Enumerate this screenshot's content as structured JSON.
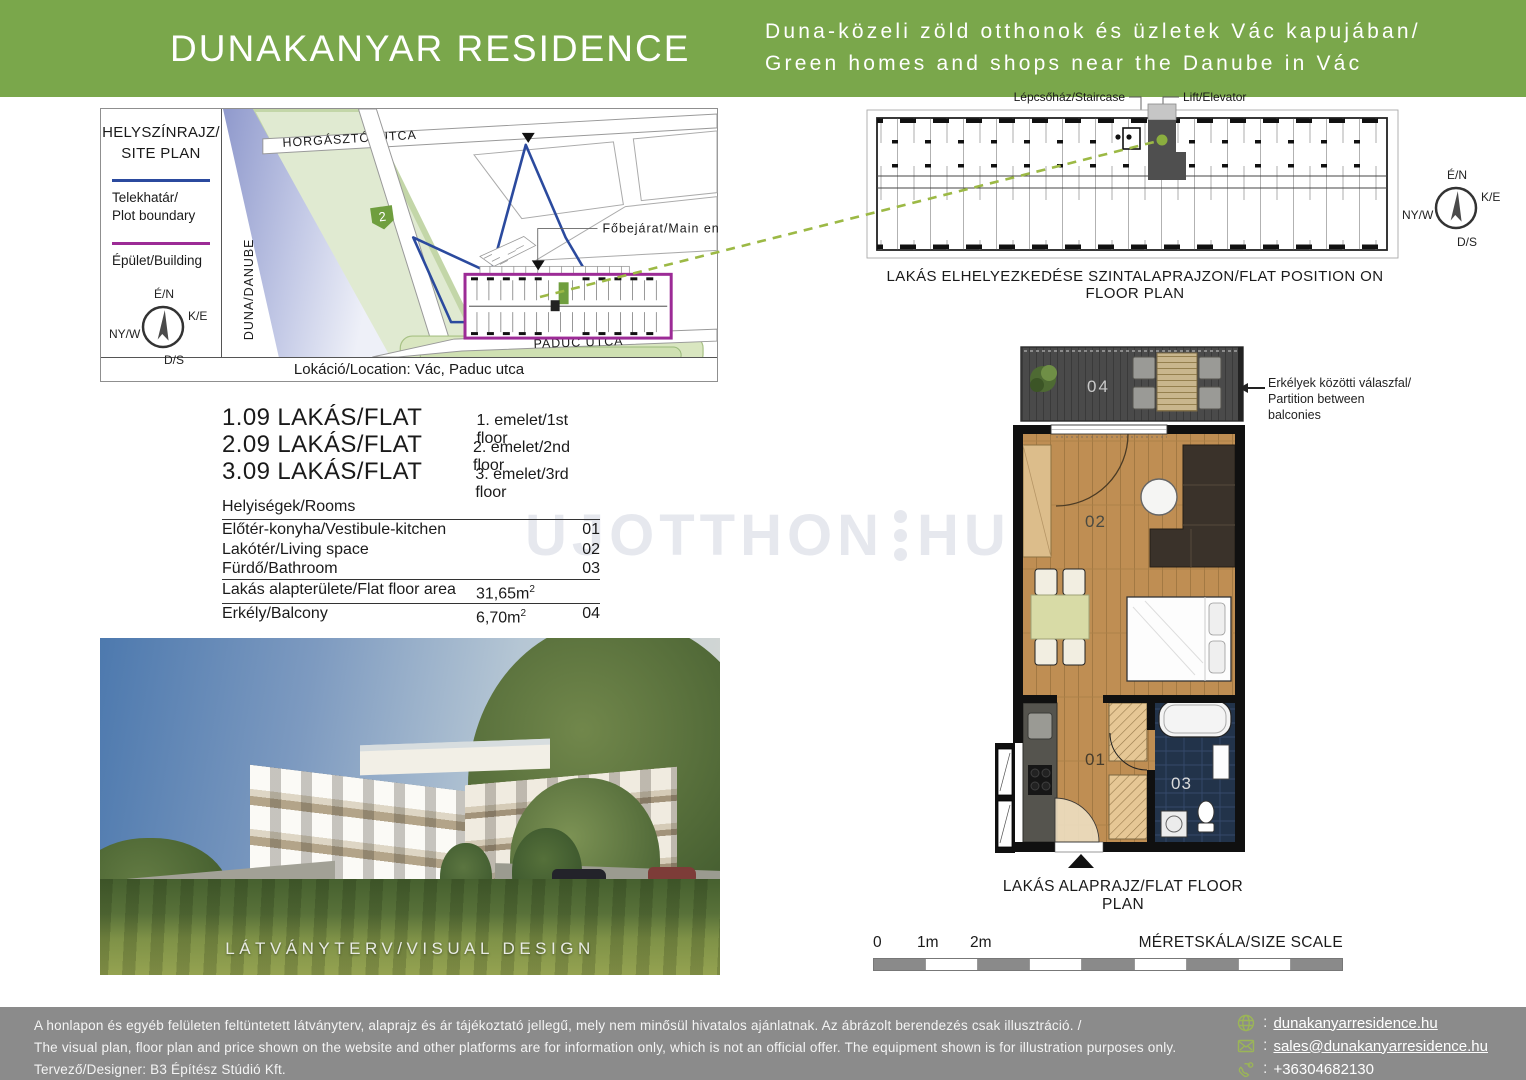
{
  "header": {
    "brand": "DUNAKANYAR RESIDENCE",
    "tagline_hu": "Duna-közeli zöld otthonok és üzletek Vác kapujában/",
    "tagline_en": "Green homes and shops near the Danube in Vác"
  },
  "site_plan": {
    "title_line1": "HELYSZÍNRAJZ/",
    "title_line2": "SITE PLAN",
    "legend_plot_line1": "Telekhatár/",
    "legend_plot_line2": "Plot boundary",
    "legend_building": "Épület/Building",
    "compass": {
      "n": "É/N",
      "e": "K/E",
      "w": "NY/W",
      "s": "D/S"
    },
    "river_label": "DUNA/DANUBE",
    "street_top": "HORGÁSZTÓI UTCA",
    "street_bottom": "PADUC UTCA",
    "road_badge": "2",
    "entrance_label": "Főbejárat/Main entrance",
    "caption": "Lokáció/Location: Vác, Paduc utca"
  },
  "floor_strip": {
    "label_staircase": "Lépcsőház/Staircase",
    "label_elevator": "Lift/Elevator",
    "caption": "LAKÁS ELHELYEZKEDÉSE SZINTALAPRAJZON/FLAT POSITION ON FLOOR PLAN",
    "compass": {
      "n": "É/N",
      "e": "K/E",
      "w": "NY/W",
      "s": "D/S"
    }
  },
  "flats": [
    {
      "id": "1.09 LAKÁS/FLAT",
      "floor": "1. emelet/1st floor"
    },
    {
      "id": "2.09 LAKÁS/FLAT",
      "floor": "2. emelet/2nd floor"
    },
    {
      "id": "3.09 LAKÁS/FLAT",
      "floor": "3. emelet/3rd floor"
    }
  ],
  "rooms": {
    "header": "Helyiségek/Rooms",
    "items": [
      {
        "label": "Előtér-konyha/Vestibule-kitchen",
        "num": "01"
      },
      {
        "label": "Lakótér/Living space",
        "num": "02"
      },
      {
        "label": "Fürdő/Bathroom",
        "num": "03"
      }
    ],
    "area_row": {
      "label": "Lakás alapterülete/Flat floor area",
      "value": "31,65m",
      "sup": "2"
    },
    "balcony_row": {
      "label": "Erkély/Balcony",
      "value": "6,70m",
      "sup": "2",
      "num": "04"
    }
  },
  "watermark": {
    "part1": "UJOTTHON",
    "part2": "HU"
  },
  "render": {
    "caption": "LÁTVÁNYTERV/VISUAL DESIGN"
  },
  "flat_plan": {
    "caption": "LAKÁS ALAPRAJZ/FLAT FLOOR PLAN",
    "annotation_line1": "Erkélyek közötti válaszfal/",
    "annotation_line2": "Partition between balconies",
    "room_labels": {
      "balcony": "04",
      "living": "02",
      "vestibule": "01",
      "bath": "03"
    }
  },
  "scale": {
    "ticks": [
      "0",
      "1m",
      "2m"
    ],
    "label": "MÉRETSKÁLA/SIZE SCALE",
    "segments": 9
  },
  "footer": {
    "disclaimer_hu": "A honlapon és egyéb felületen feltüntetett látványterv, alaprajz és ár tájékoztató jellegű, mely nem minősül hivatalos ajánlatnak. Az ábrázolt berendezés csak illusztráció. /",
    "disclaimer_en": "The visual plan, floor plan and price shown on the website and other platforms are for information only, which is not an official offer. The equipment shown is for illustration purposes only.",
    "designer": "Tervező/Designer:  B3 Építész Stúdió Kft.",
    "contacts": [
      {
        "icon": "globe-icon",
        "separator": ":",
        "label": "dunakanyarresidence.hu"
      },
      {
        "icon": "mail-icon",
        "separator": ":",
        "label": "sales@dunakanyarresidence.hu"
      },
      {
        "icon": "phone-icon",
        "separator": ":",
        "label": "+36304682130"
      }
    ]
  },
  "colors": {
    "brand_green": "#7aa74b",
    "accent_green": "#8cb14e",
    "plot_boundary_blue": "#2b4a9e",
    "building_purple": "#9c2b96",
    "footer_gray": "#8b8b8b"
  }
}
